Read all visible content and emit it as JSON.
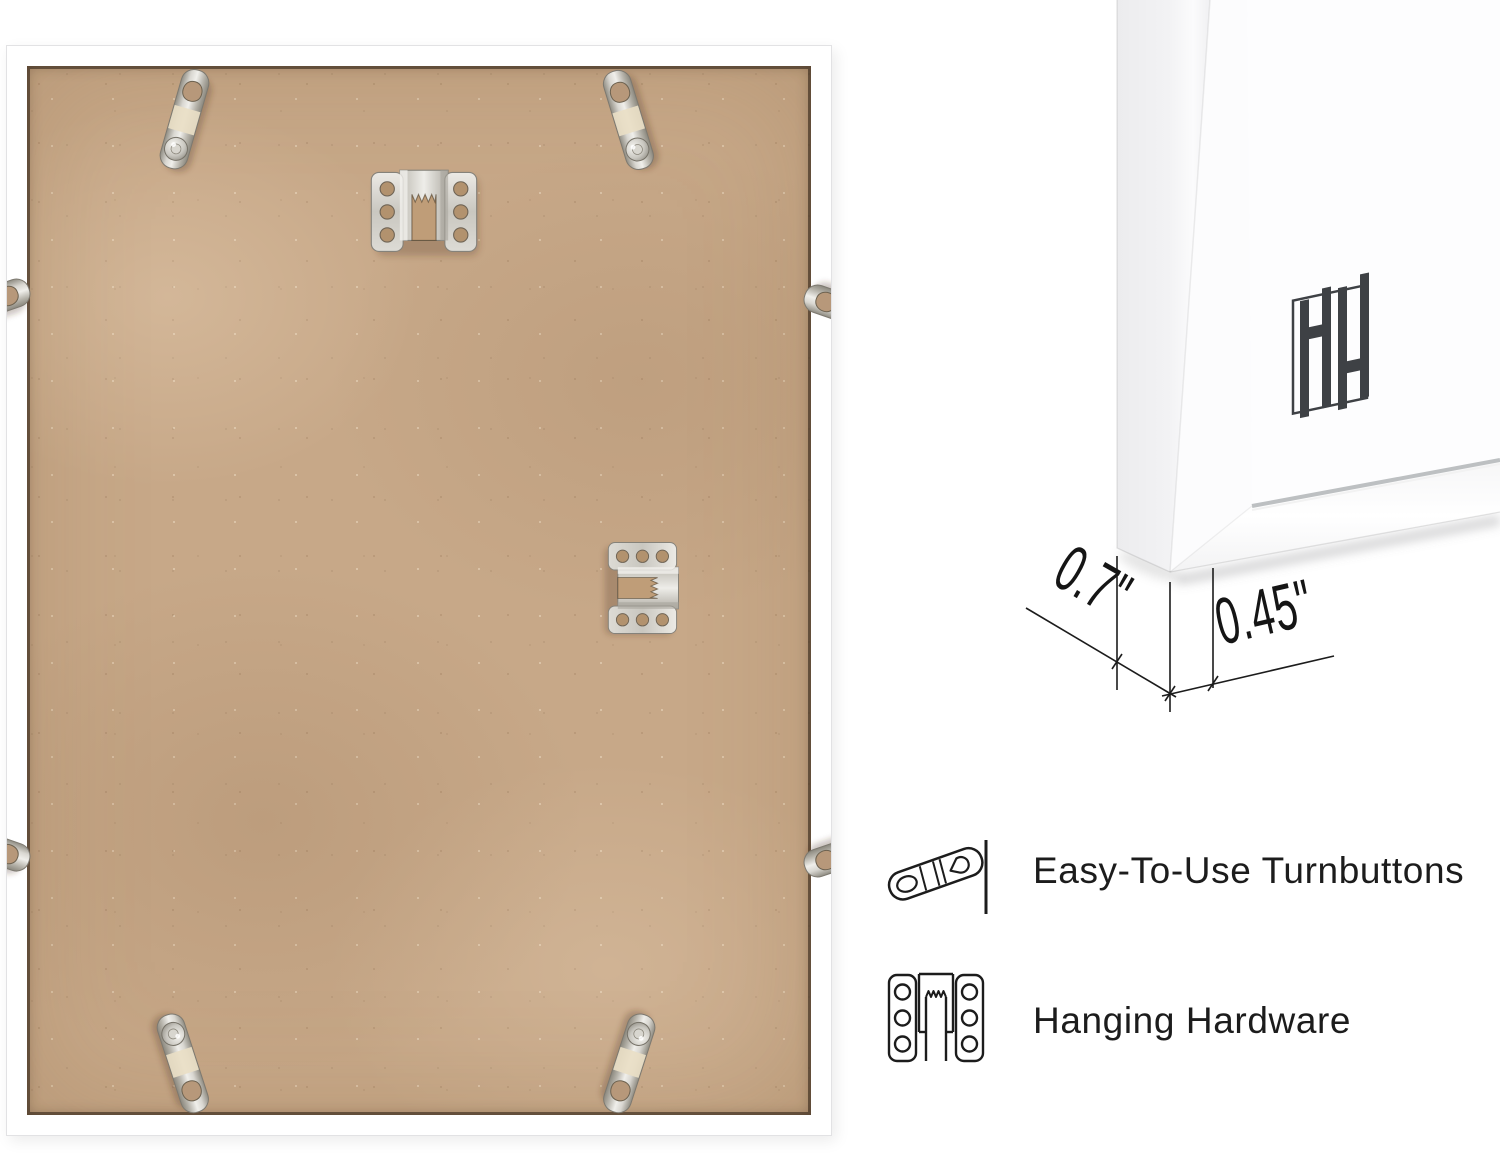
{
  "page": {
    "background_color": "#ffffff",
    "text_color": "#1c1c1c"
  },
  "photo": {
    "description": "Back of white picture frame with MDF backing board",
    "board_color": "#c7a888",
    "frame_color": "#ffffff",
    "turnbutton_count": 8,
    "hanger_count": 2
  },
  "side_view": {
    "depth_label": "0.7\"",
    "face_label": "0.45\"",
    "logo": "hh-monogram",
    "logo_color": "#3e4145"
  },
  "features": [
    {
      "icon": "turnbutton-icon",
      "label": "Easy-To-Use Turnbuttons"
    },
    {
      "icon": "hanging-hardware-icon",
      "label": "Hanging Hardware"
    }
  ]
}
